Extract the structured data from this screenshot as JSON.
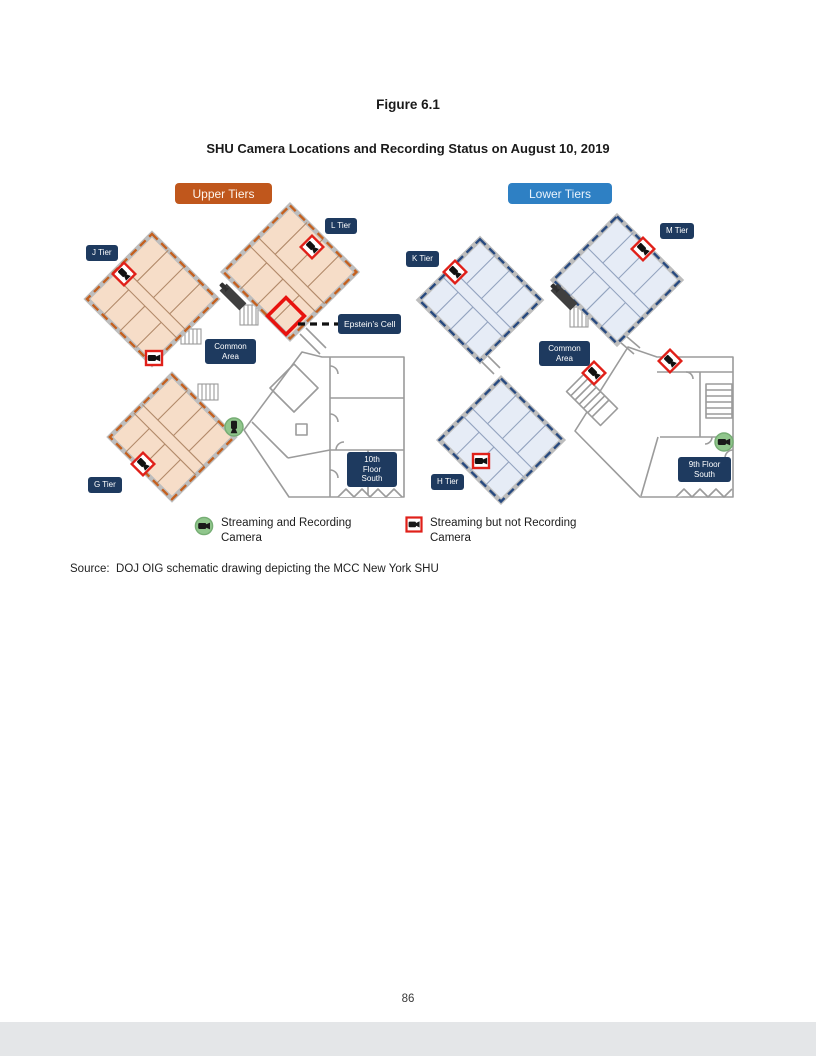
{
  "page": {
    "figure_label": "Figure 6.1",
    "figure_title": "SHU Camera Locations and Recording Status on August 10, 2019",
    "source_text": "Source:  DOJ OIG schematic drawing depicting the MCC New York SHU",
    "page_number": "86"
  },
  "diagram": {
    "upper": {
      "header": "Upper Tiers",
      "header_color": "#c0571c",
      "tiers": {
        "j": "J Tier",
        "l": "L Tier",
        "g": "G Tier"
      },
      "common_area_lines": [
        "Common",
        "Area"
      ],
      "epstein_cell_label": "Epstein’s Cell",
      "floor_label_lines": [
        "10th",
        "Floor",
        "South"
      ]
    },
    "lower": {
      "header": "Lower Tiers",
      "header_color": "#2e80c4",
      "tiers": {
        "k": "K Tier",
        "m": "M Tier",
        "h": "H Tier"
      },
      "common_area_lines": [
        "Common",
        "Area"
      ],
      "floor_label_lines": [
        "9th Floor",
        "South"
      ]
    },
    "colors": {
      "upper_accent": "#c0571c",
      "lower_accent": "#2e80c4",
      "label_navy": "#1e3a5f",
      "camera_red": "#e02019",
      "camera_green": "#90c68c",
      "upper_block_fill": "#f6ddc8",
      "lower_block_fill": "#e6ecf6",
      "epstein_cell_red": "#e8120e"
    }
  },
  "legend": {
    "items": [
      {
        "icon": "green-recording-camera-icon",
        "lines": [
          "Streaming and Recording",
          "Camera"
        ]
      },
      {
        "icon": "red-not-recording-camera-icon",
        "lines": [
          "Streaming but not Recording",
          "Camera"
        ]
      }
    ]
  }
}
